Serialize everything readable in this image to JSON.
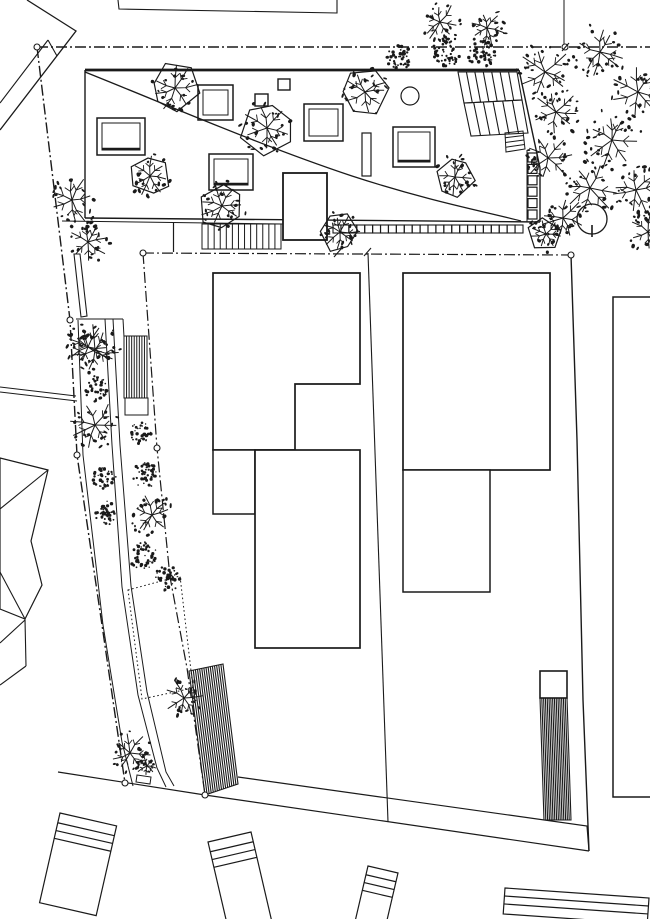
{
  "meta": {
    "title": "architectural-site-plan",
    "width": 650,
    "height": 919,
    "background": "#ffffff",
    "ink": "#1a1a1a"
  },
  "shapes": [
    {
      "n": "neighbor-top-left-wall",
      "t": "pl",
      "p": [
        [
          27,
          0
        ],
        [
          76,
          31
        ],
        [
          0,
          130
        ]
      ],
      "w": 1.3
    },
    {
      "n": "neighbor-top-left-wall-inner",
      "t": "pl",
      "p": [
        [
          48,
          40
        ],
        [
          0,
          103
        ]
      ],
      "w": 1.1
    },
    {
      "n": "neighbor-top-left-step",
      "t": "l",
      "p": [
        48,
        40,
        57,
        56
      ],
      "w": 1.1
    },
    {
      "n": "neighbor-top-edge",
      "t": "pl",
      "p": [
        [
          118,
          0
        ],
        [
          119,
          9
        ],
        [
          337,
          13
        ],
        [
          337,
          0
        ]
      ],
      "w": 1.1
    },
    {
      "n": "neighbor-parcel-line-top",
      "t": "l",
      "p": [
        564,
        0,
        564,
        47
      ],
      "w": 1
    },
    {
      "n": "neighbor-right-building",
      "t": "pl",
      "p": [
        [
          650,
          297
        ],
        [
          613,
          297
        ],
        [
          613,
          797
        ],
        [
          650,
          797
        ]
      ],
      "w": 1.5
    },
    {
      "n": "neighbor-left-fence-a",
      "t": "l",
      "p": [
        0,
        387,
        76,
        396
      ],
      "w": 1
    },
    {
      "n": "neighbor-left-fence-b",
      "t": "l",
      "p": [
        0,
        392,
        77,
        401
      ],
      "w": 1
    },
    {
      "n": "neighbor-left-house-outline",
      "t": "pl",
      "p": [
        [
          0,
          458
        ],
        [
          48,
          470
        ],
        [
          31,
          541
        ],
        [
          42,
          585
        ],
        [
          25,
          619
        ],
        [
          0,
          609
        ]
      ],
      "w": 1.2,
      "c": 1
    },
    {
      "n": "neighbor-left-house-hip-a",
      "t": "l",
      "p": [
        48,
        470,
        0,
        509
      ],
      "w": 1.1
    },
    {
      "n": "neighbor-left-house-hip-b",
      "t": "l",
      "p": [
        25,
        619,
        0,
        572
      ],
      "w": 1.1
    },
    {
      "n": "neighbor-left-gable-a",
      "t": "l",
      "p": [
        0,
        643,
        25,
        620
      ],
      "w": 1.1
    },
    {
      "n": "neighbor-left-gable-b",
      "t": "l",
      "p": [
        0,
        685,
        26,
        666
      ],
      "w": 1.1
    },
    {
      "n": "neighbor-left-gable-c",
      "t": "l",
      "p": [
        25,
        619,
        26,
        666
      ],
      "w": 1.1
    },
    {
      "n": "street-edge-top",
      "t": "pl",
      "p": [
        [
          238,
          777
        ],
        [
          587,
          826
        ],
        [
          589,
          851
        ]
      ],
      "w": 1.2
    },
    {
      "n": "street-edge-bottom",
      "t": "pl",
      "p": [
        [
          58,
          772
        ],
        [
          205,
          795
        ],
        [
          589,
          851
        ]
      ],
      "w": 1.2
    },
    {
      "n": "parked-vehicle-1",
      "t": "car",
      "a": [
        60,
        813
      ],
      "b": [
        116.6,
        825.9
      ],
      "h": 92,
      "s": [
        10,
        18,
        26
      ],
      "w": 1.2
    },
    {
      "n": "parked-vehicle-2",
      "t": "car",
      "a": [
        208,
        842
      ],
      "b": [
        251,
        832
      ],
      "h": 95,
      "s": [
        10,
        18,
        26
      ],
      "w": 1.2
    },
    {
      "n": "parked-vehicle-3",
      "t": "car",
      "a": [
        368,
        866
      ],
      "b": [
        398,
        873
      ],
      "h": 62,
      "s": [
        9,
        17,
        25
      ],
      "w": 1.2
    },
    {
      "n": "neighbor-bottom-band",
      "t": "car",
      "a": [
        505,
        888
      ],
      "b": [
        649,
        898
      ],
      "h": 26,
      "s": [
        8,
        16
      ],
      "w": 1.2
    },
    {
      "n": "property-boundary-top",
      "t": "l",
      "p": [
        37,
        47,
        650,
        47
      ],
      "w": 1.4,
      "d": "11 3 2 3"
    },
    {
      "n": "property-boundary-left",
      "t": "pl",
      "p": [
        [
          37,
          47
        ],
        [
          70,
          320
        ],
        [
          77,
          455
        ],
        [
          102,
          625
        ],
        [
          125,
          783
        ]
      ],
      "w": 1.4,
      "d": "11 3 2 3"
    },
    {
      "n": "parcel-boundary-horizontal",
      "t": "l",
      "p": [
        143,
        253,
        571,
        255
      ],
      "w": 1.2,
      "d": "11 3 2 3"
    },
    {
      "n": "parcel-boundary-left",
      "t": "pl",
      "p": [
        [
          143,
          253
        ],
        [
          157,
          448
        ],
        [
          170,
          577
        ],
        [
          187,
          668
        ],
        [
          205,
          795
        ]
      ],
      "w": 1.2,
      "d": "11 3 2 3"
    },
    {
      "n": "parcel-boundary-right",
      "t": "pl",
      "p": [
        [
          571,
          255
        ],
        [
          577,
          440
        ],
        [
          583,
          700
        ],
        [
          589,
          851
        ]
      ],
      "w": 1.4
    },
    {
      "n": "parcel-division-line",
      "t": "l",
      "p": [
        368,
        253,
        388,
        822
      ],
      "w": 1.1
    },
    {
      "n": "roof-outline-left",
      "t": "l",
      "p": [
        85,
        70,
        85,
        218
      ],
      "w": 1.4
    },
    {
      "n": "roof-outline-bottom",
      "t": "l",
      "p": [
        85,
        218,
        540,
        222
      ],
      "w": 1.4
    },
    {
      "n": "terrace-edge-line",
      "t": "l",
      "p": [
        62,
        221,
        283,
        224
      ],
      "w": 1
    },
    {
      "n": "roof-outline-top",
      "t": "l",
      "p": [
        85,
        70,
        519,
        70
      ],
      "w": 2.8
    },
    {
      "n": "roof-outline-right",
      "t": "pl",
      "p": [
        [
          519,
          70
        ],
        [
          540,
          168
        ],
        [
          540,
          222
        ]
      ],
      "w": 1.4
    },
    {
      "n": "roof-curve",
      "t": "p",
      "d": "M85,72 C175,108 262,146 352,176 C432,202 487,212 521,221",
      "w": 1.3
    },
    {
      "n": "roof-gallery-line",
      "t": "l",
      "p": [
        527,
        150,
        527,
        222
      ],
      "w": 1
    },
    {
      "n": "skylight-1",
      "t": "sky",
      "p": [
        97,
        118,
        48,
        37
      ],
      "i": 5,
      "sh": 1
    },
    {
      "n": "skylight-2",
      "t": "sky",
      "p": [
        198,
        85,
        35,
        35
      ],
      "i": 5
    },
    {
      "n": "skylight-3",
      "t": "sky",
      "p": [
        209,
        154,
        44,
        36
      ],
      "i": 5,
      "sh": 1
    },
    {
      "n": "skylight-4",
      "t": "sky",
      "p": [
        304,
        104,
        39,
        37
      ],
      "i": 5
    },
    {
      "n": "skylight-5",
      "t": "sky",
      "p": [
        393,
        127,
        42,
        40
      ],
      "i": 5,
      "sh": 1
    },
    {
      "n": "roof-vent-1",
      "t": "r",
      "p": [
        278,
        79,
        12,
        11
      ],
      "w": 1.4
    },
    {
      "n": "roof-vent-2",
      "t": "r",
      "p": [
        255,
        94,
        13,
        12
      ],
      "w": 1.4
    },
    {
      "n": "roof-circle",
      "t": "c",
      "p": [
        410,
        96,
        9
      ],
      "w": 1.2
    },
    {
      "n": "roof-chimney",
      "t": "r",
      "p": [
        362,
        133,
        9,
        43
      ],
      "w": 1.2
    },
    {
      "n": "roof-stair-flight-1",
      "t": "st",
      "e1": [
        [
          458,
          72
        ],
        [
          517,
          72
        ]
      ],
      "e2": [
        [
          464,
          103
        ],
        [
          522,
          100
        ]
      ],
      "nn": 7,
      "w": 1.1
    },
    {
      "n": "roof-stair-flight-2",
      "t": "st",
      "e1": [
        [
          464,
          103
        ],
        [
          522,
          100
        ]
      ],
      "e2": [
        [
          471,
          136
        ],
        [
          528,
          133
        ]
      ],
      "nn": 6,
      "w": 1.1
    },
    {
      "n": "roof-stair-small",
      "t": "st",
      "e1": [
        [
          505,
          133
        ],
        [
          506,
          152
        ]
      ],
      "e2": [
        [
          523,
          131
        ],
        [
          525,
          149
        ]
      ],
      "nn": 4,
      "w": 1
    },
    {
      "n": "roof-square-column",
      "t": "sq",
      "a": [
        528,
        153
      ],
      "b": [
        528,
        210
      ],
      "nn": 6,
      "s": 9,
      "w": 1.2
    },
    {
      "n": "trellis-square-row",
      "t": "sq",
      "a": [
        333,
        225
      ],
      "b": [
        515,
        225
      ],
      "nn": 24,
      "s": 8,
      "w": 1.1
    },
    {
      "n": "terrace-stair",
      "t": "st",
      "e1": [
        [
          202,
          224
        ],
        [
          281,
          224
        ]
      ],
      "e2": [
        [
          202,
          249
        ],
        [
          281,
          249
        ]
      ],
      "nn": 13,
      "w": 1
    },
    {
      "n": "terrace-wall-line",
      "t": "l",
      "p": [
        173.5,
        223,
        173.5,
        252
      ],
      "w": 1.2
    },
    {
      "n": "stair-core-volume",
      "t": "r",
      "p": [
        283,
        173,
        44,
        67
      ],
      "w": 1.8,
      "f": "#ffffff"
    },
    {
      "n": "building-left-upper",
      "t": "pl",
      "p": [
        [
          213,
          273
        ],
        [
          360,
          273
        ],
        [
          360,
          384
        ],
        [
          295,
          384
        ],
        [
          295,
          450
        ],
        [
          213,
          450
        ]
      ],
      "c": 1,
      "w": 1.7,
      "f": "#ffffff"
    },
    {
      "n": "building-left-annex",
      "t": "r",
      "p": [
        213,
        450,
        42,
        64
      ],
      "w": 1.5,
      "f": "#ffffff"
    },
    {
      "n": "building-left-lower",
      "t": "r",
      "p": [
        255,
        450,
        105,
        198
      ],
      "w": 1.7,
      "f": "#ffffff"
    },
    {
      "n": "building-right-main",
      "t": "r",
      "p": [
        403,
        273,
        147,
        197
      ],
      "w": 1.7,
      "f": "#ffffff"
    },
    {
      "n": "building-right-annex",
      "t": "r",
      "p": [
        403,
        470,
        87,
        122
      ],
      "w": 1.5,
      "f": "#ffffff"
    },
    {
      "n": "garden-stair-large",
      "t": "st",
      "e1": [
        [
          189,
          671
        ],
        [
          223,
          664
        ]
      ],
      "e2": [
        [
          205,
          795
        ],
        [
          238,
          784
        ]
      ],
      "nn": 16,
      "w": 1.1
    },
    {
      "n": "street-stair-landing",
      "t": "r",
      "p": [
        540,
        671,
        27,
        27
      ],
      "w": 1.6,
      "f": "#ffffff"
    },
    {
      "n": "street-stair-ladder",
      "t": "st",
      "e1": [
        [
          540,
          698
        ],
        [
          567,
          698
        ]
      ],
      "e2": [
        [
          544,
          820
        ],
        [
          571,
          820
        ]
      ],
      "nn": 15,
      "w": 1.1
    },
    {
      "n": "walkway-line-a",
      "t": "pl",
      "p": [
        [
          105,
          319
        ],
        [
          112,
          445
        ],
        [
          122,
          587
        ],
        [
          138,
          695
        ],
        [
          157,
          768
        ],
        [
          166,
          787
        ]
      ],
      "w": 1
    },
    {
      "n": "walkway-line-b",
      "t": "pl",
      "p": [
        [
          113,
          319
        ],
        [
          120,
          445
        ],
        [
          131,
          586
        ],
        [
          147,
          692
        ],
        [
          166,
          772
        ],
        [
          174,
          786
        ]
      ],
      "w": 1
    },
    {
      "n": "planting-bed-left-edge",
      "t": "pl",
      "p": [
        [
          78,
          320
        ],
        [
          83,
          455
        ],
        [
          103,
          625
        ],
        [
          122,
          742
        ],
        [
          133,
          786
        ]
      ],
      "w": 1
    },
    {
      "n": "planting-bed-top-edge",
      "t": "l",
      "p": [
        76,
        319,
        123,
        319
      ],
      "w": 1
    },
    {
      "n": "planting-bed-right-edge",
      "t": "l",
      "p": [
        123,
        319,
        124,
        337
      ],
      "w": 1
    },
    {
      "n": "garden-wall",
      "t": "pl",
      "p": [
        [
          74,
          254
        ],
        [
          80,
          254
        ],
        [
          87,
          316
        ],
        [
          81,
          317
        ]
      ],
      "c": 1,
      "w": 1.1,
      "f": "#ffffff"
    },
    {
      "n": "path-stair",
      "t": "st",
      "e1": [
        [
          124,
          336
        ],
        [
          147,
          336
        ]
      ],
      "e2": [
        [
          124,
          398
        ],
        [
          147,
          398
        ]
      ],
      "nn": 9,
      "w": 1
    },
    {
      "n": "path-stair-landing",
      "t": "r",
      "p": [
        125,
        398,
        23,
        17
      ],
      "w": 1
    },
    {
      "n": "proposed-footprint-dotted",
      "t": "pl",
      "p": [
        [
          128,
          590
        ],
        [
          180,
          576
        ],
        [
          193,
          688
        ],
        [
          142,
          699
        ]
      ],
      "c": 1,
      "w": 1,
      "d": "1.6 2.6"
    },
    {
      "n": "garden-bench",
      "t": "pl",
      "p": [
        [
          137,
          775
        ],
        [
          151,
          777
        ],
        [
          150,
          784
        ],
        [
          136,
          782
        ]
      ],
      "c": 1,
      "w": 1
    },
    {
      "n": "tree-circle-symbol",
      "t": "c",
      "p": [
        592,
        219,
        15
      ],
      "w": 1.3
    },
    {
      "n": "tree-circle-stem",
      "t": "l",
      "p": [
        592,
        225,
        592,
        237
      ],
      "w": 1.6
    }
  ],
  "ticks": [
    [
      334,
      257,
      341,
      249
    ],
    [
      364,
      256,
      371,
      248
    ],
    [
      562,
      51,
      569,
      43
    ]
  ],
  "nodes": [
    [
      37,
      47
    ],
    [
      565,
      47
    ],
    [
      143,
      253
    ],
    [
      571,
      255
    ],
    [
      70,
      320
    ],
    [
      77,
      455
    ],
    [
      157,
      448
    ],
    [
      125,
      783
    ],
    [
      205,
      795
    ]
  ],
  "trees": {
    "outlined": [
      [
        175,
        88,
        24
      ],
      [
        267,
        128,
        26
      ],
      [
        150,
        176,
        21
      ],
      [
        222,
        206,
        24
      ],
      [
        365,
        92,
        23
      ],
      [
        455,
        177,
        21
      ],
      [
        340,
        232,
        20
      ],
      [
        546,
        234,
        18
      ]
    ],
    "twiggy": [
      [
        95,
        350,
        26
      ],
      [
        95,
        425,
        25
      ],
      [
        152,
        515,
        22
      ],
      [
        130,
        753,
        21
      ],
      [
        184,
        698,
        20
      ],
      [
        72,
        200,
        26
      ],
      [
        88,
        242,
        22
      ],
      [
        88,
        347,
        22
      ],
      [
        440,
        22,
        20
      ],
      [
        487,
        28,
        18
      ],
      [
        147,
        766,
        11
      ],
      [
        545,
        72,
        28
      ],
      [
        600,
        52,
        27
      ],
      [
        638,
        92,
        28
      ],
      [
        556,
        112,
        25
      ],
      [
        612,
        140,
        30
      ],
      [
        548,
        158,
        24
      ],
      [
        590,
        188,
        28
      ],
      [
        636,
        190,
        26
      ],
      [
        563,
        218,
        22
      ],
      [
        648,
        232,
        20
      ]
    ],
    "shrubs": [
      [
        399,
        58,
        13
      ],
      [
        447,
        51,
        15
      ],
      [
        482,
        55,
        14
      ],
      [
        96,
        388,
        12
      ],
      [
        140,
        433,
        11
      ],
      [
        146,
        475,
        13
      ],
      [
        104,
        478,
        12
      ],
      [
        107,
        513,
        12
      ],
      [
        143,
        556,
        14
      ],
      [
        168,
        578,
        13
      ]
    ]
  }
}
